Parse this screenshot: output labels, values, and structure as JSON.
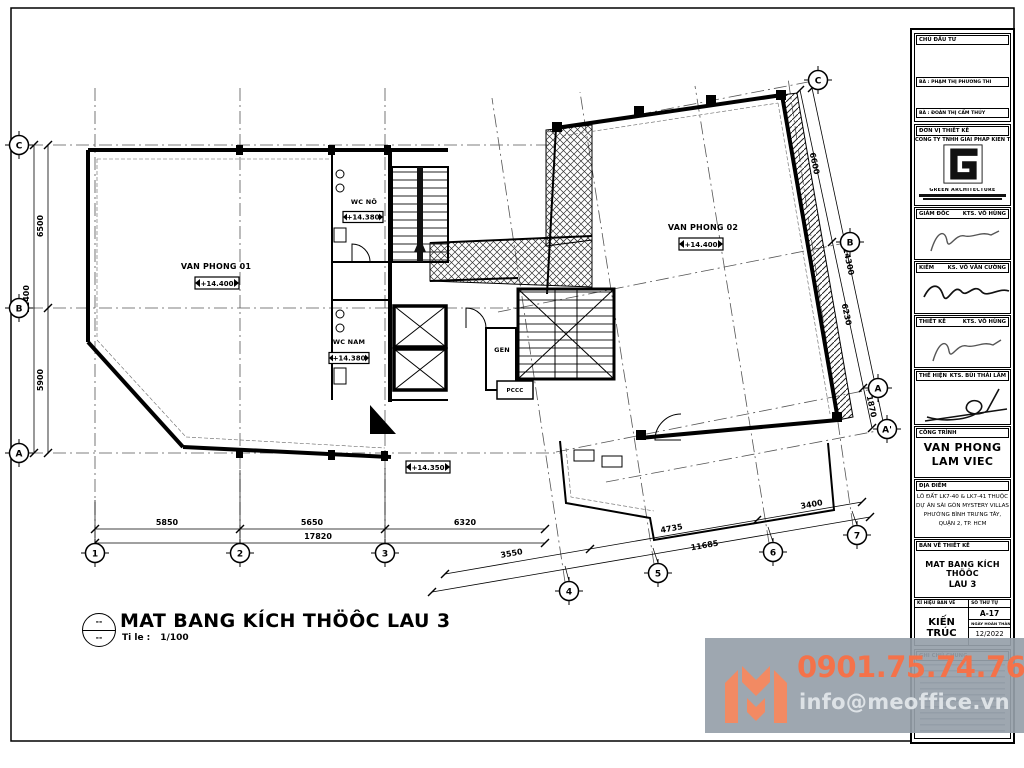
{
  "colors": {
    "accent_orange": "#f4724a",
    "logo_coral": "#f28a63",
    "watermark_band": "#96a0aa",
    "ink": "#000000"
  },
  "plan": {
    "rooms": {
      "vp01": "VAN PHONG 01",
      "vp02": "VAN PHONG 02",
      "wc_nu": "WC NÖ",
      "wc_nam": "WC NAM",
      "gen": "GEN",
      "pccc": "PCCC"
    },
    "elevations": {
      "vp01": "+14.400",
      "vp02": "+14.400",
      "wc_nu": "+14.380",
      "wc_nam": "+14.380",
      "balcony": "+14.350"
    },
    "dims": {
      "bottom": [
        "5850",
        "5650",
        "6320",
        "17820"
      ],
      "bottom_right": [
        "3550",
        "4735",
        "3400",
        "11685"
      ],
      "left": [
        "6500",
        "5900",
        "12400"
      ],
      "right": [
        "6600",
        "6230",
        "1870",
        "14300"
      ]
    },
    "grid": {
      "cols": [
        "1",
        "2",
        "3",
        "4",
        "5",
        "6",
        "7"
      ],
      "rows_left": [
        "C",
        "B",
        "A"
      ],
      "rows_right": [
        "C",
        "B",
        "A",
        "A'"
      ]
    }
  },
  "drawing_title": {
    "bubble_top": "--",
    "bubble_bottom": "--",
    "name": "MAT BANG KÍCH THÖÔC LAU 3",
    "scale_label": "Ti le :",
    "scale_value": "1/100"
  },
  "titleblock": {
    "owner_header": "CHỦ ĐẦU TƯ",
    "owner_1": "BÀ : PHẠM THỊ PHƯƠNG THI",
    "owner_2": "BÀ : ĐOÀN THỊ CẨM THÚY",
    "designer_header": "ĐƠN VỊ THIẾT KẾ",
    "company": "CÔNG TY TNHH GIẢI PHÁP KIẾN TRÚC XANH",
    "brand": "GREEN ARCHITECTURE",
    "roles": [
      {
        "label": "GIÁM ĐỐC",
        "name": "KTS. VÕ HÙNG"
      },
      {
        "label": "KIỂM",
        "name": "KS. VÕ VĂN CƯỜNG"
      },
      {
        "label": "THIẾT KẾ",
        "name": "KTS. VÕ HÙNG"
      },
      {
        "label": "THỂ HIỆN",
        "name": "KTS. BÙI THÁI LÂM"
      }
    ],
    "project_header": "CÔNG TRÌNH",
    "project_line1": "VAN PHONG",
    "project_line2": "LAM VIEC",
    "location_header": "ĐỊA ĐIỂM",
    "location_lines": [
      "LÔ ĐẤT LK7-40 & LK7-41 THUỘC",
      "DỰ ÁN SÀI GÒN MYSTERY VILLAS",
      "PHƯỜNG BÌNH TRƯNG TÂY,",
      "QUẬN 2, TP. HCM"
    ],
    "drawing_header": "BẢN VẼ THIẾT KẾ",
    "drawing_line1": "MAT BANG KÍCH THÖÔC",
    "drawing_line2": "LAU 3",
    "symbol_header": "KÍ HIỆU BẢN VẼ",
    "discipline": "KIẾN TRÚC",
    "number_header": "SỐ THỨ TỰ",
    "sheet_number": "A-17",
    "date_header": "NGÀY HOÀN THÀNH",
    "date": "12/2022",
    "notes_header": "GHI CHÚ CHUNG"
  },
  "watermark": {
    "phone": "0901.75.74.76",
    "email": "info@meoffice.vn"
  }
}
